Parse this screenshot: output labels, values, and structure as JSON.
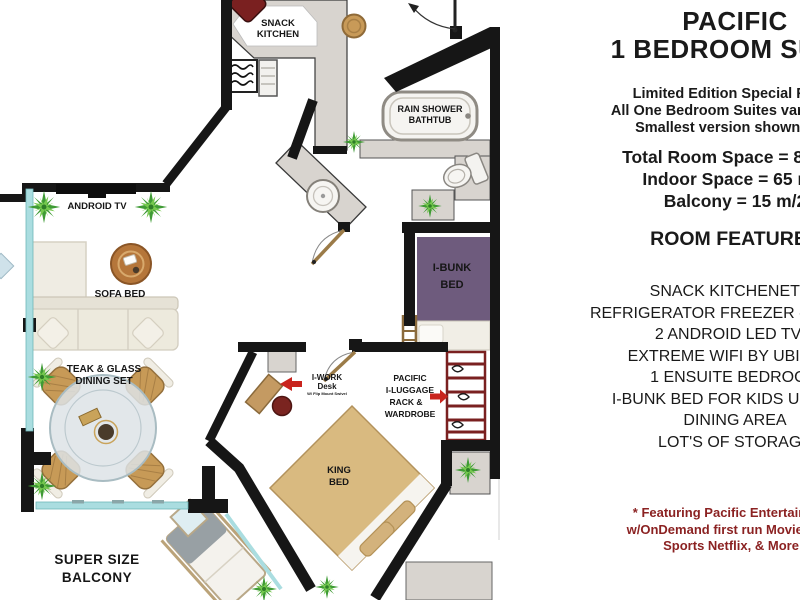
{
  "panel": {
    "title1": "PACIFIC",
    "title2": "1 BEDROOM SUITE",
    "subtitle": [
      "Limited Edition Special Room",
      "All One Bedroom Suites vary in size",
      "Smallest version shown here"
    ],
    "specs": [
      "Total Room Space = 80 m/2",
      "Indoor Space = 65 m/2",
      "Balcony  = 15 m/2"
    ],
    "features_heading": "ROOM FEATURES",
    "features": [
      "SNACK KITCHENETTE",
      "REFRIGERATOR FREEZER - MINI BAR",
      "2 ANDROID LED TV'S",
      "EXTREME WIFI BY UBIQUITI",
      "1 ENSUITE BEDROOM",
      "I-BUNK BED FOR KIDS UP TO 12",
      "DINING AREA",
      "LOT'S OF STORAGE"
    ],
    "footnote": [
      "* Featuring  Pacific Entertainment",
      "w/OnDemand first run Movies, Live",
      "Sports Netflix, & More )"
    ]
  },
  "plan": {
    "labels": {
      "snack_kitchen": [
        "SNACK",
        "KITCHEN"
      ],
      "rain_shower": [
        "RAIN SHOWER",
        "BATHTUB"
      ],
      "android_tv": "ANDROID TV",
      "sofa_bed": "SOFA BED",
      "dining": [
        "TEAK & GLASS",
        "DINING SET"
      ],
      "i_bunk": [
        "I-BUNK",
        "BED"
      ],
      "i_work": [
        "I-WORK",
        "Desk",
        "W/ Flip Mount Swivel"
      ],
      "luggage": [
        "PACIFIC",
        "I-LUGGAGE",
        "RACK &",
        "WARDROBE"
      ],
      "king_bed": [
        "KING",
        "BED"
      ],
      "balcony": [
        "SUPER SIZE",
        "BALCONY"
      ]
    },
    "colors": {
      "wall": "#161616",
      "glass": "#aadde0",
      "marble": "#d8d4cf",
      "bunk_panel": "#6e5b7d",
      "bed_tan": "#d9ba80",
      "arrow_red": "#c9241d",
      "accent_maroon": "#7a2020",
      "plant_green": "#3f9b35",
      "footnote_red": "#8b2222"
    }
  }
}
